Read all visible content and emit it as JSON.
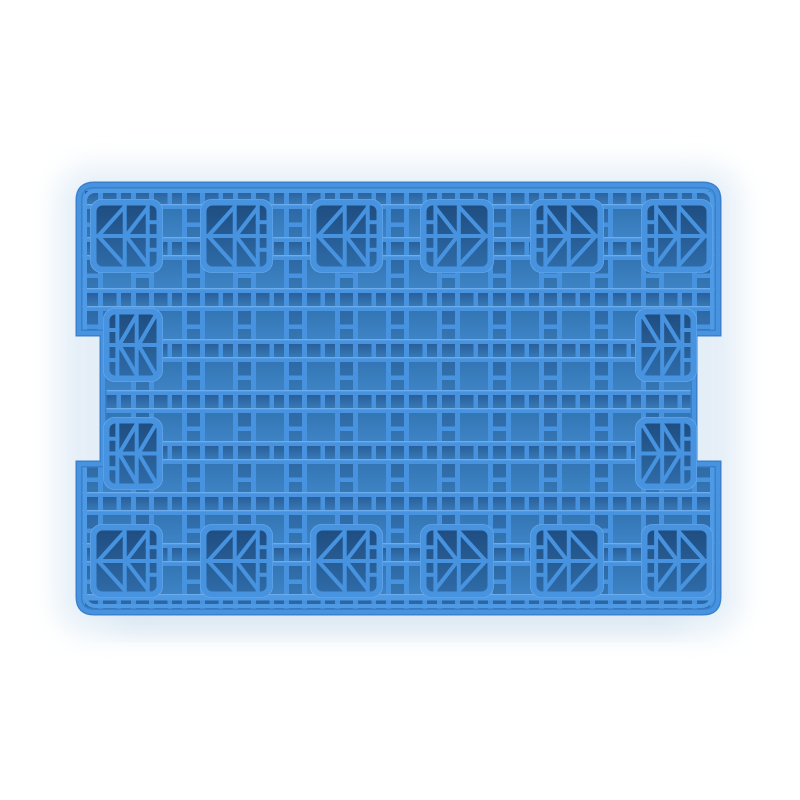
{
  "scene": {
    "type": "product-photo",
    "subject": "Blue plastic pallet, top view",
    "background_color": "#ffffff",
    "glow_color": "#e2edf7",
    "shadow_color": "#cfdfec"
  },
  "pallet": {
    "colors": {
      "rib": "#4793df",
      "rib_highlight": "#6cacec",
      "rim_outer": "#3a80cc",
      "rim_inner": "#4f9ae4",
      "cell_big_top": "#2e6da9",
      "cell_big_bottom": "#3f86c8",
      "cell_small_top": "#295f9b",
      "cell_small_bottom": "#3679b6",
      "foot_top": "#1e4c7f",
      "foot_bottom": "#2f6ca9"
    },
    "geometry": {
      "x": 79,
      "y": 185,
      "width": 639,
      "height": 427,
      "corner_radius": 15,
      "notch_top": 333,
      "notch_bottom": 464,
      "notch_depth": 24,
      "grid_origin_x": 85,
      "grid_origin_y": 191,
      "grid_pitch": 51,
      "grid_rib": 5,
      "grid_narrow": 13,
      "lip_y": 596
    },
    "feet": [
      {
        "x": 90,
        "y": 199,
        "w": 73,
        "h": 74,
        "dir": "left",
        "variant": "standard"
      },
      {
        "x": 200,
        "y": 199,
        "w": 73,
        "h": 74,
        "dir": "left",
        "variant": "standard"
      },
      {
        "x": 310,
        "y": 199,
        "w": 73,
        "h": 74,
        "dir": "left",
        "variant": "standard"
      },
      {
        "x": 420,
        "y": 199,
        "w": 74,
        "h": 74,
        "dir": "right",
        "variant": "standard"
      },
      {
        "x": 530,
        "y": 199,
        "w": 74,
        "h": 74,
        "dir": "right",
        "variant": "standard"
      },
      {
        "x": 641,
        "y": 199,
        "w": 72,
        "h": 74,
        "dir": "right",
        "variant": "standard"
      },
      {
        "x": 103,
        "y": 308,
        "w": 60,
        "h": 74,
        "dir": "left",
        "variant": "edge"
      },
      {
        "x": 635,
        "y": 308,
        "w": 62,
        "h": 74,
        "dir": "right",
        "variant": "edge"
      },
      {
        "x": 103,
        "y": 417,
        "w": 60,
        "h": 73,
        "dir": "left",
        "variant": "edge"
      },
      {
        "x": 635,
        "y": 417,
        "w": 62,
        "h": 73,
        "dir": "right",
        "variant": "edge"
      },
      {
        "x": 90,
        "y": 524,
        "w": 73,
        "h": 74,
        "dir": "left",
        "variant": "standard"
      },
      {
        "x": 200,
        "y": 524,
        "w": 73,
        "h": 74,
        "dir": "left",
        "variant": "standard"
      },
      {
        "x": 310,
        "y": 524,
        "w": 73,
        "h": 74,
        "dir": "left",
        "variant": "standard"
      },
      {
        "x": 420,
        "y": 524,
        "w": 74,
        "h": 74,
        "dir": "right",
        "variant": "standard"
      },
      {
        "x": 530,
        "y": 524,
        "w": 74,
        "h": 74,
        "dir": "right",
        "variant": "standard"
      },
      {
        "x": 641,
        "y": 524,
        "w": 72,
        "h": 74,
        "dir": "right",
        "variant": "standard"
      }
    ],
    "foot_patterns": {
      "standard": [
        {
          "x1": 0,
          "y1": 0.5,
          "x2": 1,
          "y2": 0.5
        },
        {
          "x1": 0.47,
          "y1": 0,
          "x2": 0.47,
          "y2": 1
        },
        {
          "x1": 0.86,
          "y1": 0,
          "x2": 0.86,
          "y2": 1
        },
        {
          "x1": 0.86,
          "y1": 0.27,
          "x2": 1,
          "y2": 0.27
        },
        {
          "x1": 0.86,
          "y1": 0.73,
          "x2": 1,
          "y2": 0.73
        },
        {
          "x1": 0.02,
          "y1": 0.5,
          "x2": 0.45,
          "y2": 0.03
        },
        {
          "x1": 0.02,
          "y1": 0.5,
          "x2": 0.45,
          "y2": 0.97
        },
        {
          "x1": 0.49,
          "y1": 0.5,
          "x2": 0.84,
          "y2": 0.05
        },
        {
          "x1": 0.49,
          "y1": 0.5,
          "x2": 0.84,
          "y2": 0.95
        }
      ],
      "edge": [
        {
          "x1": 0,
          "y1": 0.5,
          "x2": 1,
          "y2": 0.5
        },
        {
          "x1": 0.16,
          "y1": 0,
          "x2": 0.16,
          "y2": 1
        },
        {
          "x1": 0,
          "y1": 0.25,
          "x2": 0.16,
          "y2": 0.25
        },
        {
          "x1": 0,
          "y1": 0.75,
          "x2": 0.16,
          "y2": 0.75
        },
        {
          "x1": 0.58,
          "y1": 0,
          "x2": 0.58,
          "y2": 1
        },
        {
          "x1": 0.2,
          "y1": 0.5,
          "x2": 0.55,
          "y2": 0.04
        },
        {
          "x1": 0.2,
          "y1": 0.5,
          "x2": 0.55,
          "y2": 0.96
        },
        {
          "x1": 0.62,
          "y1": 0.5,
          "x2": 0.96,
          "y2": 0.05
        },
        {
          "x1": 0.62,
          "y1": 0.5,
          "x2": 0.96,
          "y2": 0.95
        }
      ]
    }
  }
}
